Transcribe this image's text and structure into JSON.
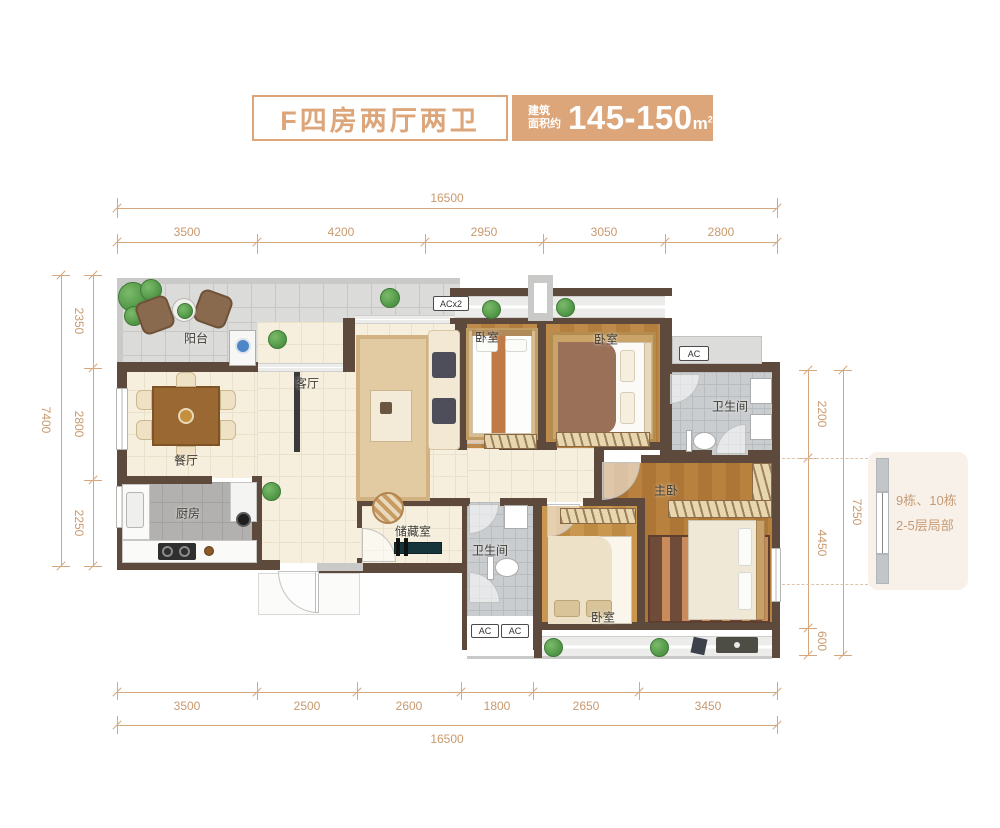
{
  "title": {
    "name": "F四房两厅两卫",
    "area_label_line1": "建筑",
    "area_label_line2": "面积约",
    "area_value": "145-150",
    "area_unit_base": "m",
    "area_unit_sup": "2"
  },
  "note": {
    "line1": "9栋、10栋",
    "line2": "2-5层局部"
  },
  "rooms": {
    "balcony": "阳台",
    "living": "客厅",
    "dining": "餐厅",
    "kitchen": "厨房",
    "storage": "储藏室",
    "bath1": "卫生间",
    "bath2": "卫生间",
    "bed1": "卧室",
    "bed2": "卧室",
    "bed3": "卧室",
    "master": "主卧"
  },
  "ac": {
    "acx2": "ACx2",
    "ac_ne": "AC",
    "ac_s1": "AC",
    "ac_s2": "AC"
  },
  "dims": {
    "top": {
      "total": "16500",
      "segments": [
        "3500",
        "4200",
        "2950",
        "3050",
        "2800"
      ]
    },
    "bottom": {
      "total": "16500",
      "segments": [
        "3500",
        "2500",
        "2600",
        "1800",
        "2650",
        "3450"
      ]
    },
    "left": {
      "total": "7400",
      "segments": [
        "2350",
        "2800",
        "2250"
      ]
    },
    "right": {
      "total": "7250",
      "segments": [
        "2200",
        "4450",
        "600"
      ]
    }
  },
  "colors": {
    "accent": "#DCA67A",
    "dim_line": "#D5A77C",
    "dim_text": "#C8996D",
    "wall": "#5E4A3C",
    "note_bg": "#F8F1E9",
    "note_text": "#C69B76",
    "floor_cream": "#F6EFDD",
    "floor_gray": "#DBDBD9",
    "floor_kitchen": "#B2B1AF",
    "floor_bath": "#CACDCF"
  }
}
